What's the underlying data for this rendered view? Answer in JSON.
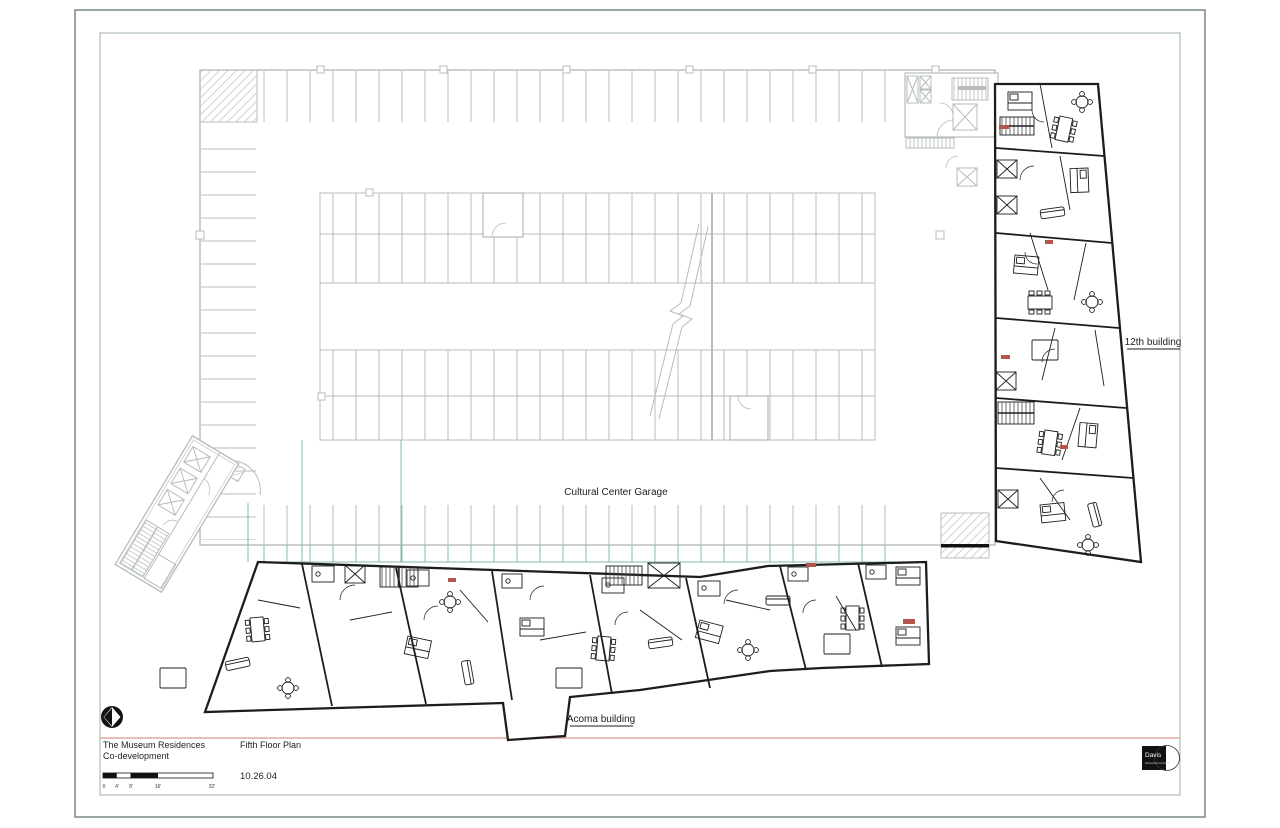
{
  "drawing": {
    "labels": {
      "garage": "Cultural Center Garage",
      "right_building": "12th building",
      "bottom_building": "Acoma building"
    }
  },
  "title_block": {
    "project_name_line1": "The Museum Residences",
    "project_name_line2": "Co-development",
    "sheet_title": "Fifth Floor Plan",
    "date": "10.26.04",
    "scale_labels": [
      "0",
      "4'",
      "8'",
      "16'",
      "32'"
    ],
    "firm_name": "Davis",
    "firm_subtitle": "Partnership Architects"
  },
  "colors": {
    "garage_lines": "#b6bdbb",
    "building_lines": "#1d1d1d",
    "teal_accent": "#82b7b2",
    "red_accent": "#b5544d",
    "divider_salmon": "#dfa9a2",
    "sheet_border": "#6f8080"
  }
}
